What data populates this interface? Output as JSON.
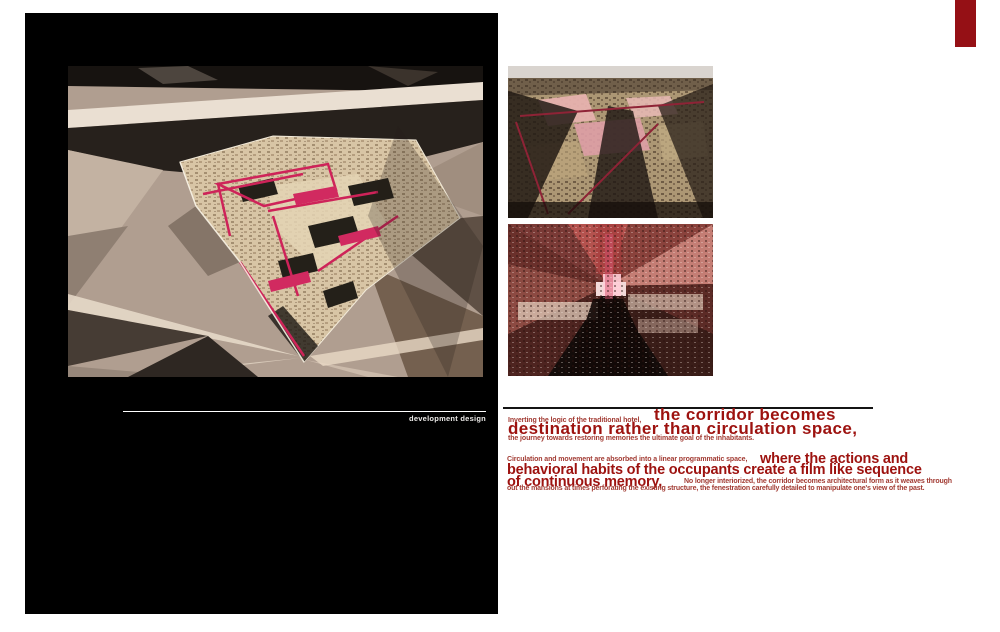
{
  "page": {
    "background": "#ffffff",
    "accent_color": "#951015",
    "panel_color": "#000000",
    "big_text_color": "#9d120f",
    "small_text_color": "#a23b33"
  },
  "left_panel": {
    "caption": "development design"
  },
  "images": {
    "main_render": "development design aerial render of hotel plan with magenta corridor walls",
    "top_right_render": "aerial render of textured hotel massing with pink roof patches",
    "bottom_right_render": "interior corridor perspective render in red tones"
  },
  "statement_1": {
    "small_lead": "Inverting the logic of the traditional hotel,",
    "big_line_1": "the corridor becomes",
    "big_line_2": "destination rather than circulation space,",
    "small_tail": "the journey towards restoring memories the ultimate goal of the inhabitants."
  },
  "statement_2": {
    "small_lead": "Circulation and movement are absorbed into a linear programmatic space,",
    "big_line_1": "where the actions and",
    "big_line_2": "behavioral habits of the occupants create a film like sequence",
    "big_line_3": "of continuous memory,",
    "small_tail_1": "No longer interiorized, the corridor becomes architectural form as it weaves through",
    "small_tail_2": "out the mansions at times perforating the existing structure, the fenestration carefully detailed to manipulate one's view of the past."
  }
}
